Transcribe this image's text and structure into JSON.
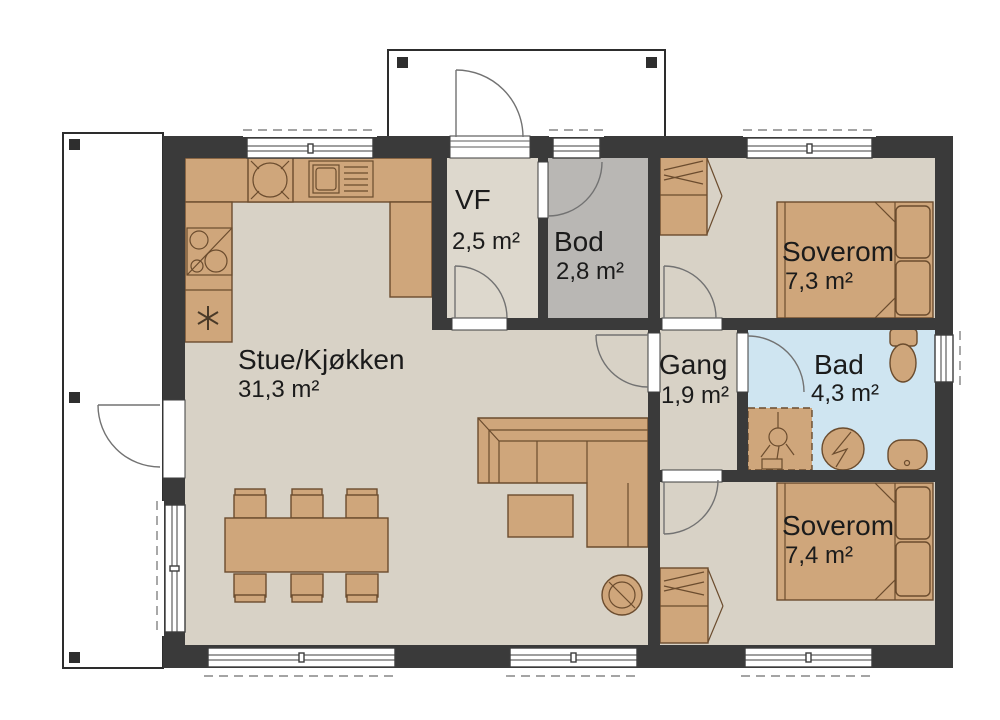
{
  "rooms": [
    {
      "id": "stue-kjokken",
      "name": "Stue/Kjøkken",
      "area": "31,3 m²"
    },
    {
      "id": "vf",
      "name": "VF",
      "area": "2,5 m²"
    },
    {
      "id": "bod",
      "name": "Bod",
      "area": "2,8 m²"
    },
    {
      "id": "soverom-1",
      "name": "Soverom",
      "area": "7,3 m²"
    },
    {
      "id": "gang",
      "name": "Gang",
      "area": "1,9 m²"
    },
    {
      "id": "bad",
      "name": "Bad",
      "area": "4,3 m²"
    },
    {
      "id": "soverom-2",
      "name": "Soverom",
      "area": "7,4 m²"
    }
  ],
  "symbols": {
    "kitchen": [
      "cooktop-icon",
      "sink-icon",
      "prep-basin-icon",
      "fridge-snowflake-icon"
    ],
    "living": [
      "dining-table",
      "six-chairs",
      "corner-sofa",
      "coffee-table",
      "wood-stove-icon"
    ],
    "bedroom_1": [
      "double-bed",
      "wardrobe"
    ],
    "bedroom_2": [
      "double-bed",
      "wardrobe"
    ],
    "bathroom": [
      "toilet-icon",
      "shower-icon",
      "washing-machine-icon",
      "washbasin-icon"
    ],
    "exterior": [
      "entrance-porch",
      "terrace"
    ]
  },
  "colors": {
    "wall": "#3a3a3a",
    "floor-beige": "#d8d2c6",
    "floor-vf": "#ddd8cd",
    "floor-gray": "#b9b7b4",
    "floor-blue": "#cfe5f1",
    "furn": "#cfa67b",
    "furn-stroke": "#6b4c2e",
    "text": "#1b1b1b"
  }
}
